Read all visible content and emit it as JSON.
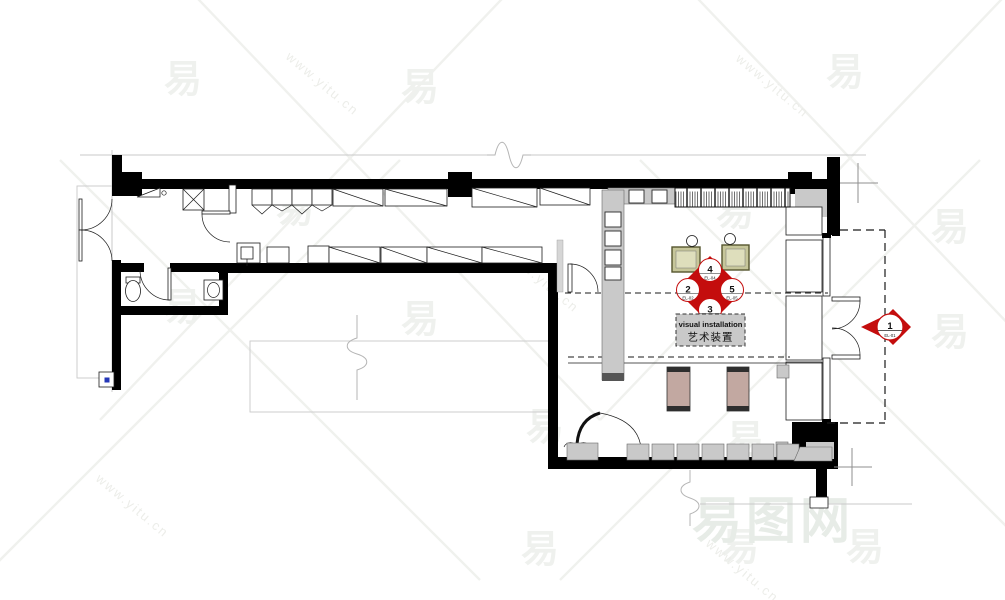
{
  "labels": {
    "installation_line1": "visual installation",
    "installation_line2": "艺术装置"
  },
  "markers": {
    "diamond": {
      "top_num": "4",
      "top_sheet": "EL-04",
      "left_num": "2",
      "left_sheet": "EL-02",
      "right_num": "5",
      "right_sheet": "EL-05",
      "bottom_num": "3",
      "bottom_sheet": "EL-03"
    },
    "single": {
      "num": "1",
      "sheet": "EL-01"
    }
  },
  "watermark": {
    "glyph": "易",
    "brand": "易图网",
    "url": "www.yitu.cn"
  },
  "colors": {
    "marker_red": "#c40d0d",
    "bench_fill": "#c6c69a",
    "bench_inner": "#dedebc",
    "pedestal_fill": "#c2a8a1",
    "poche_gray": "#c9c9c9",
    "accent_blue": "#2437b8"
  }
}
